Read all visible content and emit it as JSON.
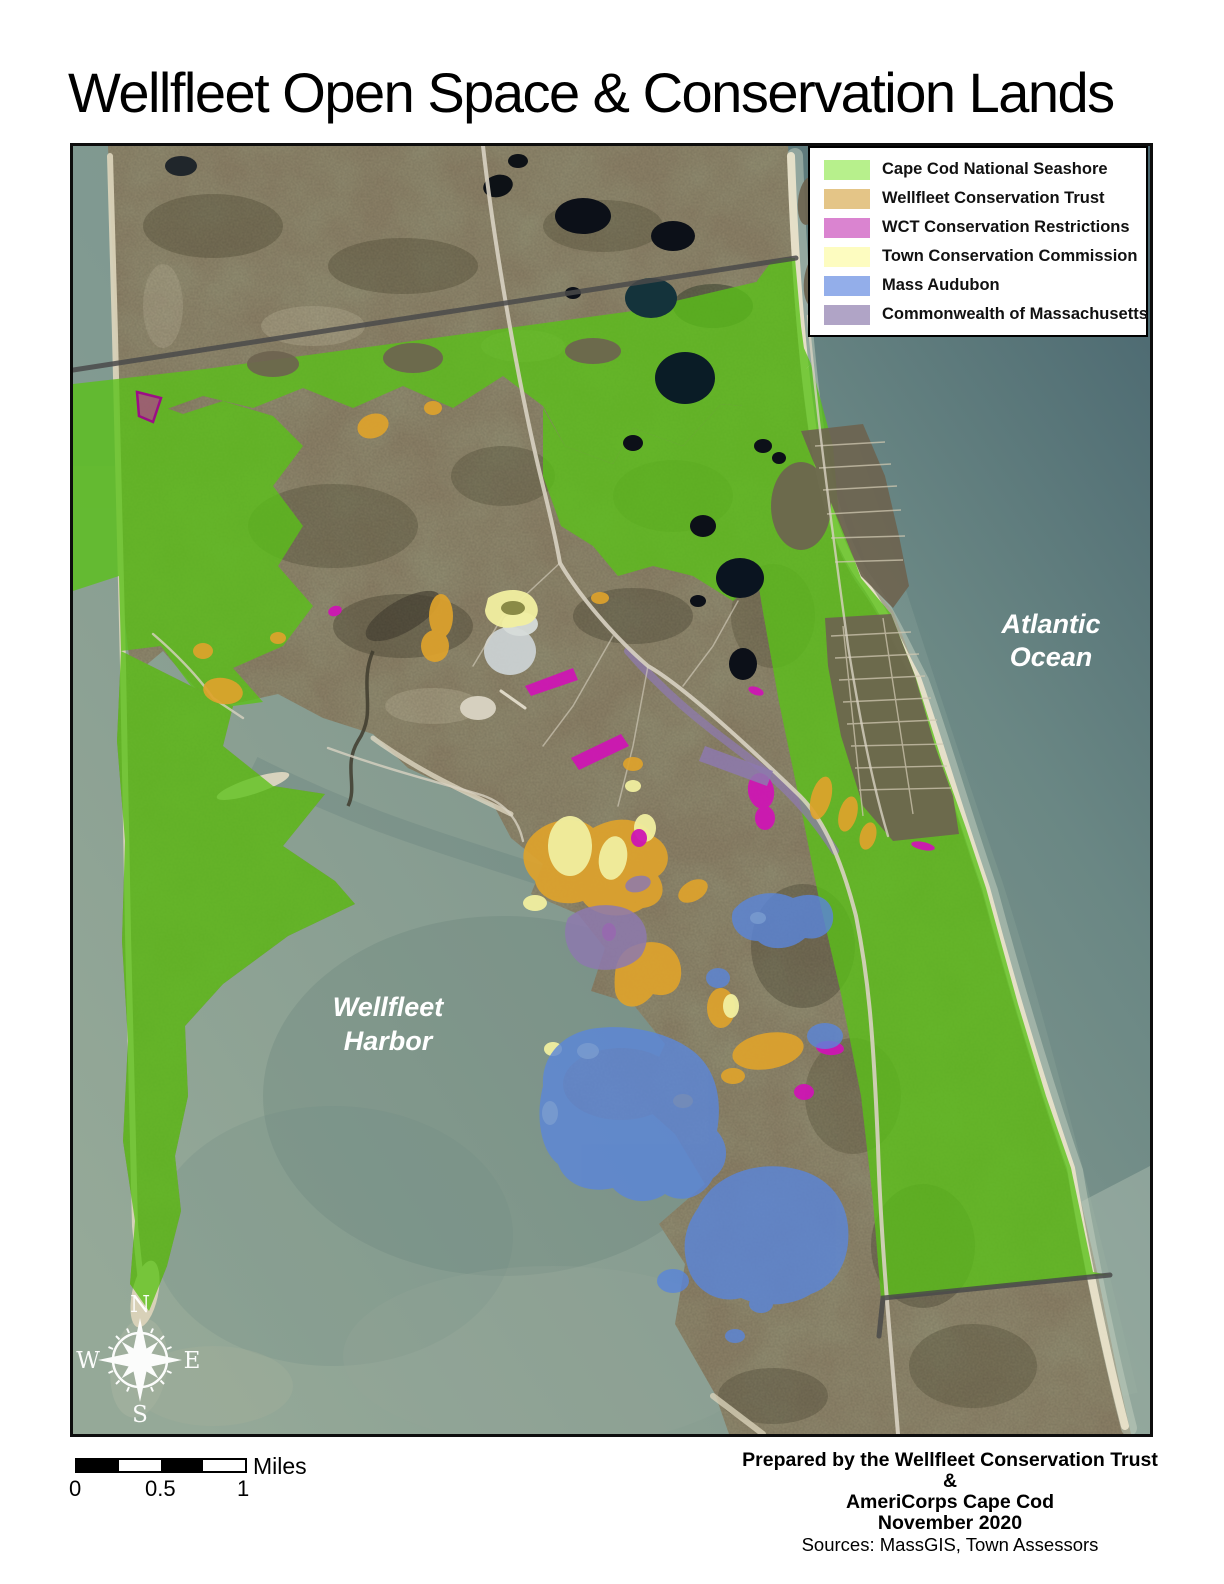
{
  "title": "Wellfleet Open Space & Conservation Lands",
  "legend": {
    "items": [
      {
        "label": "Cape Cod National Seashore",
        "color": "#b7f08c"
      },
      {
        "label": "Wellfleet Conservation Trust",
        "color": "#e4c587"
      },
      {
        "label": "WCT Conservation Restrictions",
        "color": "#da84d0"
      },
      {
        "label": "Town Conservation Commission",
        "color": "#fdfcc0"
      },
      {
        "label": "Mass Audubon",
        "color": "#93aeea"
      },
      {
        "label": "Commonwealth of Massachusetts",
        "color": "#b0a4c6"
      }
    ]
  },
  "map": {
    "labels": {
      "ocean_line1": "Atlantic",
      "ocean_line2": "Ocean",
      "harbor_line1": "Wellfleet",
      "harbor_line2": "Harbor"
    },
    "compass": {
      "n": "N",
      "e": "E",
      "s": "S",
      "w": "W"
    },
    "overlay_colors": {
      "seashore": "#5ac217",
      "trust": "#dfa32c",
      "restrictions": "#ce16b4",
      "town": "#f1efa0",
      "audubon": "#5b86d8",
      "commonwealth": "#8d79ae"
    }
  },
  "scale_bar": {
    "ticks": [
      "0",
      "0.5",
      "1"
    ],
    "unit": "Miles"
  },
  "credits": {
    "line1": "Prepared by the Wellfleet Conservation Trust",
    "line2": "&",
    "line3": "AmeriCorps Cape Cod",
    "line4": "November 2020",
    "line5": "Sources: MassGIS, Town Assessors"
  }
}
